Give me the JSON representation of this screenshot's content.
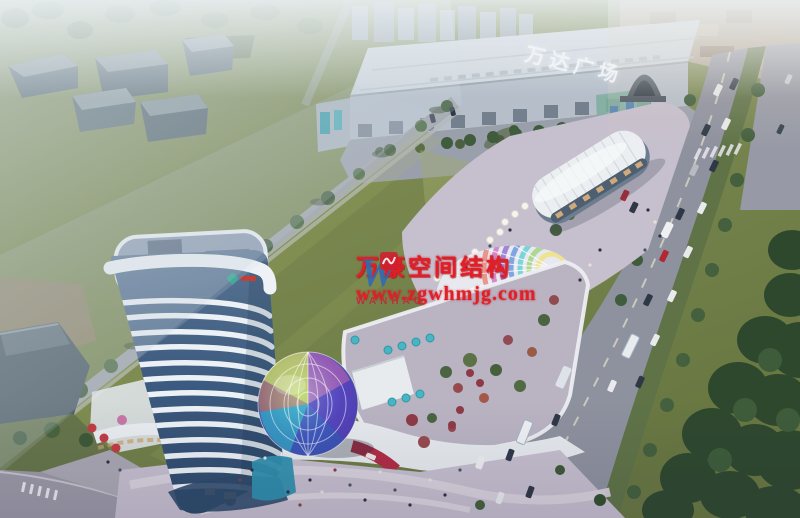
{
  "signs": {
    "mall_roof_sign": "万达广场"
  },
  "watermark": {
    "company_name": "万豪空间结构",
    "website": "www.zgwhmjg.com",
    "logo_letter": "W",
    "logo_text": "WANHAO"
  },
  "palette": {
    "text_red": "#e21e26",
    "logo_blue": "#2f6ab5",
    "logo_red": "#cf2030",
    "sign_white": "#f2f6f9",
    "lawn": "#7a8850",
    "road": "#8e919e",
    "sidewalk": "#a8a3ae",
    "verge_green": "#5f7347",
    "dark_trees": "#2e482e",
    "plaza": "#c6bfcd",
    "tower_band": "#ecf1f6",
    "tower_glass_dark": "#33517a",
    "accent_red": "#b02c44",
    "dome_purple": "#5a3cc0",
    "dome_teal": "#2fb0c8",
    "mall_wall": "#b5bec9",
    "mall_roof": "#cfd6dd",
    "haze": "#c7d0d7"
  }
}
